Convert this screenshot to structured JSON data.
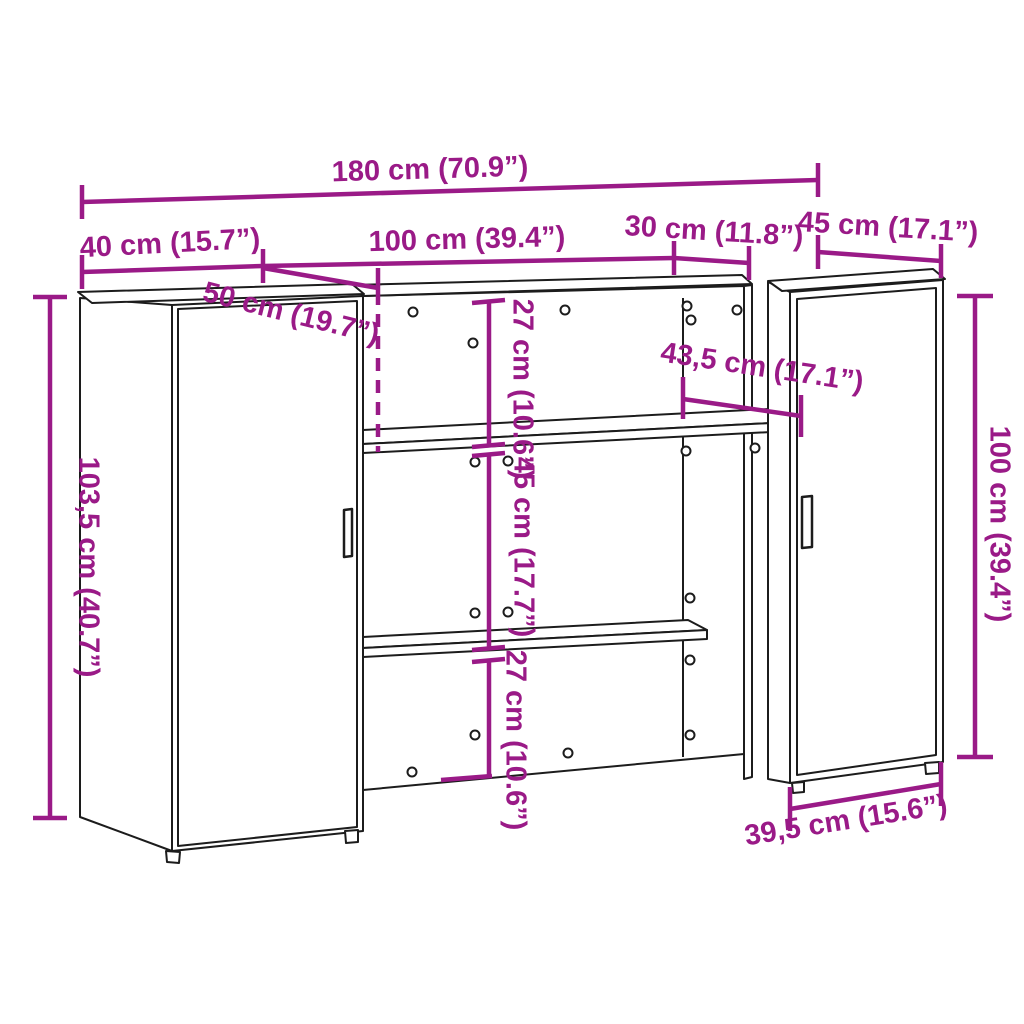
{
  "figure": {
    "type": "furniture-dimension-diagram",
    "subject": "reception desk with two cabinets and open shelves",
    "background_color": "#ffffff",
    "outline_color": "#1c1c1c",
    "dimension_color": "#9A1A87"
  },
  "dimensions": {
    "total_width": "180 cm (70.9”)",
    "left_cabinet_width": "40 cm (15.7”)",
    "middle_section_width": "100 cm (39.4”)",
    "recess_width": "30 cm (11.8”)",
    "right_cabinet_width": "45 cm (17.1”)",
    "left_cabinet_depth": "50 cm (19.7”)",
    "upper_compartment_height": "27 cm (10.6”)",
    "middle_compartment_height": "45 cm (17.7”)",
    "lower_compartment_height": "27 cm (10.6”)",
    "desktop_depth": "43,5 cm (17.1”)",
    "left_cabinet_height": "103,5 cm (40.7”)",
    "right_cabinet_height": "100 cm (39.4”)",
    "right_cabinet_depth": "39,5 cm (15.6”)"
  }
}
